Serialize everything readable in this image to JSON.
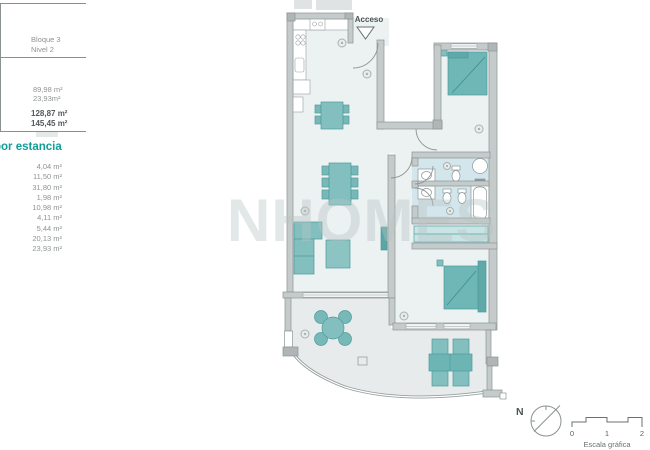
{
  "panel": {
    "block_label": "Bloque 3",
    "level_label": "Nivel 2",
    "areas": [
      "89,98 m²",
      "23,93m²"
    ],
    "totals": [
      "128,87 m²",
      "145,45 m²"
    ],
    "section_heading": "por estancia",
    "room_areas": [
      "4,04 m²",
      "11,50 m²",
      "31,80 m²",
      "1,98 m²",
      "10,98 m²",
      "4,11 m²",
      "5,44 m²",
      "20,13 m²",
      "23,93 m²"
    ]
  },
  "plan": {
    "entrance_label": "Acceso",
    "watermark": "NHOMES",
    "compass_label": "N",
    "scale": {
      "tick0": "0",
      "tick1": "1",
      "tick2": "2",
      "caption": "Escala gráfica"
    }
  },
  "colors": {
    "accent_teal": "#119e96",
    "furniture_teal": "#7fbcbc",
    "wall_gray": "#c5caca",
    "bathroom_floor": "#d3e6ec",
    "terrace_floor": "#e8ebeb"
  }
}
